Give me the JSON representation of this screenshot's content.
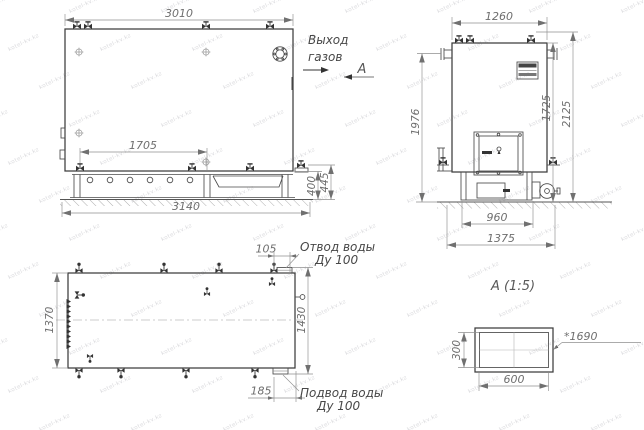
{
  "labels": {
    "gas_out_1": "Выход",
    "gas_out_2": "газов",
    "section": "А",
    "detail_title": "А (1:5)",
    "outlet_1": "Отвод воды",
    "outlet_2": "Ду 100",
    "inlet_1": "Подвод воды",
    "inlet_2": "Ду 100"
  },
  "front_view": {
    "dims": {
      "top_width": "3010",
      "grate": "1705",
      "bottom_width": "3140",
      "h_inner": "400",
      "h_outer": "445"
    }
  },
  "side_view": {
    "dims": {
      "top_width": "1260",
      "h_left": "1976",
      "h_mid": "1725",
      "h_right": "2125",
      "base_inner": "960",
      "base_outer": "1375"
    }
  },
  "plan_view": {
    "dims": {
      "outlet_off": "105",
      "left_h": "1370",
      "right_h": "1430",
      "inlet_off": "185"
    }
  },
  "detail_view": {
    "dims": {
      "h": "300",
      "w": "600",
      "ref": "*1690"
    }
  },
  "watermark": {
    "text": "kotel-kv.kz"
  },
  "colors": {
    "outline": "#3c3c3c",
    "dim_line": "#8f8f8f",
    "dim_text": "#6e6e6e",
    "background": "#ffffff"
  }
}
